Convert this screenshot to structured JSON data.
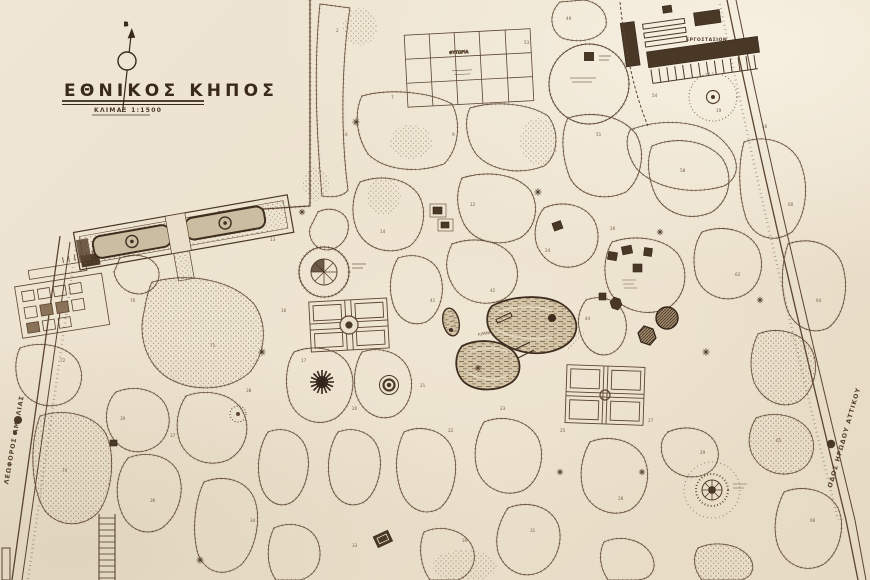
{
  "map": {
    "title": "ΕΘΝΙΚΟΣ ΚΗΠΟΣ",
    "scale_label": "ΚΛΙΜΑΞ 1:1500",
    "compass_letter": "Β",
    "roads": [
      {
        "name": "ΛΕΩΦΟΡΟΣ ΑΜΑΛΙΑΣ"
      },
      {
        "name": "ΟΔΟΣ ΗΡΩΔΟΥ ΑΤΤΙΚΟΥ"
      }
    ],
    "labels": {
      "factory": "ΕΡΓΟΣΤΑΣΙΟΝ",
      "nursery": "ΦΥΤΩΡΙΑ",
      "lake": "ΛΙΜΝΗ"
    },
    "area_markers": [
      {
        "x": 336,
        "y": 32,
        "n": "2"
      },
      {
        "x": 391,
        "y": 99,
        "n": "7"
      },
      {
        "x": 345,
        "y": 136,
        "n": "6"
      },
      {
        "x": 452,
        "y": 136,
        "n": "9"
      },
      {
        "x": 524,
        "y": 44,
        "n": "53"
      },
      {
        "x": 566,
        "y": 20,
        "n": "49"
      },
      {
        "x": 652,
        "y": 97,
        "n": "54"
      },
      {
        "x": 716,
        "y": 112,
        "n": "19"
      },
      {
        "x": 762,
        "y": 128,
        "n": "56"
      },
      {
        "x": 596,
        "y": 136,
        "n": "51"
      },
      {
        "x": 680,
        "y": 172,
        "n": "58"
      },
      {
        "x": 788,
        "y": 206,
        "n": "60"
      },
      {
        "x": 470,
        "y": 206,
        "n": "12"
      },
      {
        "x": 380,
        "y": 233,
        "n": "14"
      },
      {
        "x": 545,
        "y": 252,
        "n": "24"
      },
      {
        "x": 610,
        "y": 230,
        "n": "26"
      },
      {
        "x": 735,
        "y": 276,
        "n": "62"
      },
      {
        "x": 816,
        "y": 302,
        "n": "64"
      },
      {
        "x": 270,
        "y": 241,
        "n": "13"
      },
      {
        "x": 130,
        "y": 302,
        "n": "70"
      },
      {
        "x": 60,
        "y": 362,
        "n": "72"
      },
      {
        "x": 210,
        "y": 347,
        "n": "71"
      },
      {
        "x": 281,
        "y": 312,
        "n": "16"
      },
      {
        "x": 301,
        "y": 362,
        "n": "17"
      },
      {
        "x": 352,
        "y": 410,
        "n": "20"
      },
      {
        "x": 420,
        "y": 387,
        "n": "21"
      },
      {
        "x": 448,
        "y": 432,
        "n": "22"
      },
      {
        "x": 500,
        "y": 410,
        "n": "23"
      },
      {
        "x": 560,
        "y": 432,
        "n": "25"
      },
      {
        "x": 648,
        "y": 422,
        "n": "27"
      },
      {
        "x": 700,
        "y": 454,
        "n": "29"
      },
      {
        "x": 776,
        "y": 442,
        "n": "65"
      },
      {
        "x": 810,
        "y": 522,
        "n": "66"
      },
      {
        "x": 618,
        "y": 500,
        "n": "28"
      },
      {
        "x": 530,
        "y": 532,
        "n": "31"
      },
      {
        "x": 462,
        "y": 542,
        "n": "30"
      },
      {
        "x": 352,
        "y": 547,
        "n": "33"
      },
      {
        "x": 250,
        "y": 522,
        "n": "34"
      },
      {
        "x": 150,
        "y": 502,
        "n": "36"
      },
      {
        "x": 62,
        "y": 472,
        "n": "74"
      },
      {
        "x": 170,
        "y": 437,
        "n": "37"
      },
      {
        "x": 246,
        "y": 392,
        "n": "38"
      },
      {
        "x": 120,
        "y": 420,
        "n": "39"
      },
      {
        "x": 585,
        "y": 320,
        "n": "44"
      },
      {
        "x": 490,
        "y": 292,
        "n": "42"
      },
      {
        "x": 430,
        "y": 302,
        "n": "41"
      }
    ]
  },
  "colors": {
    "paper": "#ece3d1",
    "ink": "#46362a",
    "building_fill": "#4a3826",
    "water_base": "#d6c9ae",
    "stipple_dot": "#6d563c"
  }
}
